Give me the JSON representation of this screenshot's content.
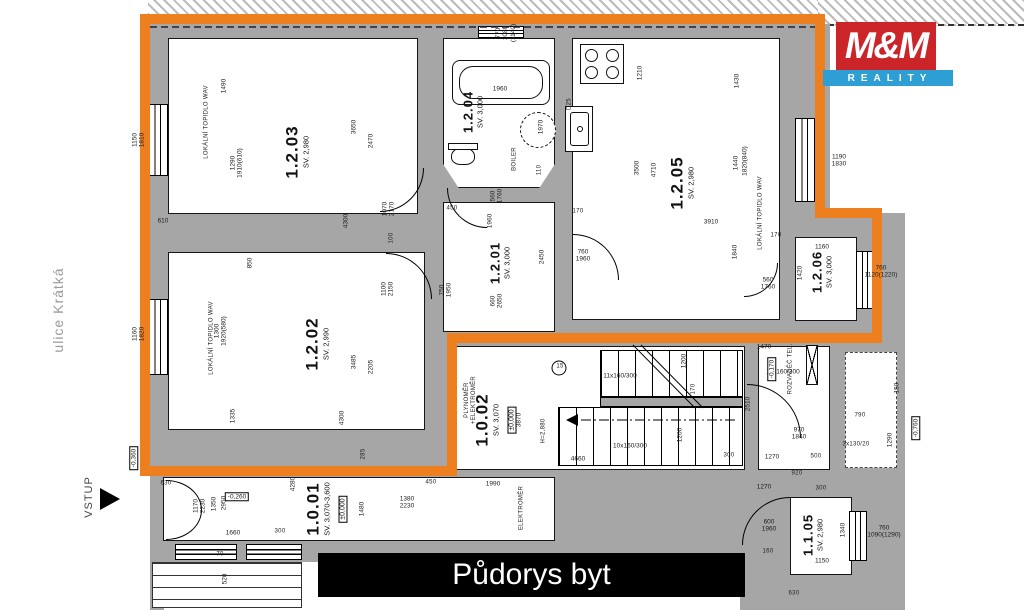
{
  "title_bar": {
    "text": "Půdorys byt"
  },
  "logo": {
    "line1": "M&M",
    "line2": "REALITY"
  },
  "street_label": "ulice Krátká",
  "entry_label": "VSTUP",
  "colors": {
    "boundary_orange": "#ee7f1e",
    "wall_gray": "#a6a6a6",
    "logo_red": "#cb2429",
    "logo_blue": "#2e9fd4",
    "title_bg": "#000000"
  },
  "rooms": [
    {
      "id": "1.2.03",
      "sv": "SV. 2,980",
      "x": 297,
      "y": 152
    },
    {
      "id": "1.2.02",
      "sv": "SV. 2,990",
      "x": 317,
      "y": 344
    },
    {
      "id": "1.2.04",
      "sv": "SV. 3,000",
      "x": 473,
      "y": 112,
      "small": true
    },
    {
      "id": "1.2.01",
      "sv": "SV. 3,000",
      "x": 500,
      "y": 263,
      "small": true
    },
    {
      "id": "1.2.05",
      "sv": "SV. 2,980",
      "x": 682,
      "y": 183
    },
    {
      "id": "1.2.06",
      "sv": "SV. 3,000",
      "x": 822,
      "y": 272,
      "small": true
    },
    {
      "id": "1.0.02",
      "sv": "SV. 3,070",
      "extra": "±0,000",
      "x": 496,
      "y": 420
    },
    {
      "id": "1.0.01",
      "sv": "SV. 3,070-3,600",
      "extra": "±0,000",
      "x": 327,
      "y": 509
    },
    {
      "id": "1.1.05",
      "sv": "SV. 2,980",
      "x": 813,
      "y": 535,
      "small": true
    }
  ],
  "annotations": [
    {
      "t": "1490",
      "x": 224,
      "y": 86
    },
    {
      "t": "1290\n1910(610)",
      "x": 237,
      "y": 163
    },
    {
      "t": "1150\n1810",
      "x": 139,
      "y": 140
    },
    {
      "t": "610",
      "x": 163,
      "y": 221,
      "r": 0
    },
    {
      "t": "1160\n1820",
      "x": 139,
      "y": 334
    },
    {
      "t": "3650",
      "x": 354,
      "y": 127
    },
    {
      "t": "2470",
      "x": 371,
      "y": 141
    },
    {
      "t": "1070\n2170",
      "x": 389,
      "y": 209
    },
    {
      "t": "4300",
      "x": 346,
      "y": 221
    },
    {
      "t": "100",
      "x": 392,
      "y": 238,
      "c": "sm"
    },
    {
      "t": "LOKÁLNÍ TOPIDLO WAV",
      "x": 207,
      "y": 122,
      "c": "sm"
    },
    {
      "t": "LOKÁLNÍ TOPIDLO WAV",
      "x": 212,
      "y": 338,
      "c": "sm"
    },
    {
      "t": "850",
      "x": 250,
      "y": 263
    },
    {
      "t": "1300\n1920(580)",
      "x": 221,
      "y": 331
    },
    {
      "t": "3485",
      "x": 354,
      "y": 362
    },
    {
      "t": "2205",
      "x": 371,
      "y": 367
    },
    {
      "t": "1335",
      "x": 233,
      "y": 416
    },
    {
      "t": "4300",
      "x": 342,
      "y": 418
    },
    {
      "t": "770\n1080\n(1140)",
      "x": 506,
      "y": 33
    },
    {
      "t": "1960",
      "x": 500,
      "y": 89,
      "r": 0
    },
    {
      "t": "1970",
      "x": 541,
      "y": 127
    },
    {
      "t": "BOILER",
      "x": 515,
      "y": 159,
      "c": "sm"
    },
    {
      "t": "110",
      "x": 540,
      "y": 170,
      "c": "sm"
    },
    {
      "t": "450",
      "x": 452,
      "y": 209,
      "r": 0,
      "c": "sm"
    },
    {
      "t": "560\n1760",
      "x": 497,
      "y": 196
    },
    {
      "t": "1960",
      "x": 490,
      "y": 221
    },
    {
      "t": "2450",
      "x": 542,
      "y": 257
    },
    {
      "t": "1100\n2150",
      "x": 388,
      "y": 289
    },
    {
      "t": "750\n1950",
      "x": 446,
      "y": 290
    },
    {
      "t": "660\n2650",
      "x": 497,
      "y": 301
    },
    {
      "t": "D25",
      "x": 570,
      "y": 104,
      "c": "sm"
    },
    {
      "t": "1210",
      "x": 640,
      "y": 73
    },
    {
      "t": "1430",
      "x": 737,
      "y": 81
    },
    {
      "t": "3500",
      "x": 637,
      "y": 168
    },
    {
      "t": "4710",
      "x": 654,
      "y": 170
    },
    {
      "t": "1440",
      "x": 736,
      "y": 163
    },
    {
      "t": "1820(840)",
      "x": 745,
      "y": 161
    },
    {
      "t": "LOKÁLNÍ TOPIDLO WAV",
      "x": 761,
      "y": 213,
      "c": "sm"
    },
    {
      "t": "170",
      "x": 578,
      "y": 212,
      "r": 0,
      "c": "sm"
    },
    {
      "t": "3910",
      "x": 711,
      "y": 222,
      "r": 0
    },
    {
      "t": "1840",
      "x": 735,
      "y": 252
    },
    {
      "t": "170",
      "x": 776,
      "y": 236,
      "r": 0,
      "c": "sm"
    },
    {
      "t": "760\n1960",
      "x": 583,
      "y": 256,
      "r": 0
    },
    {
      "t": "560\n1760",
      "x": 768,
      "y": 284,
      "r": 0
    },
    {
      "t": "1420",
      "x": 800,
      "y": 273
    },
    {
      "t": "1160",
      "x": 822,
      "y": 247,
      "r": 0
    },
    {
      "t": "760\n1120(1220)",
      "x": 881,
      "y": 272,
      "r": 0
    },
    {
      "t": "1190\n1830",
      "x": 839,
      "y": 161,
      "r": 0
    },
    {
      "t": "PLYNOMĚR\n+ELEKTROMĚR",
      "x": 471,
      "y": 400,
      "c": "sm"
    },
    {
      "t": "3870",
      "x": 519,
      "y": 420
    },
    {
      "t": "H=2,880",
      "x": 544,
      "y": 431,
      "c": "sm"
    },
    {
      "t": "15",
      "x": 560,
      "y": 367,
      "r": 0,
      "c": "sm"
    },
    {
      "t": "11x160/300",
      "x": 620,
      "y": 376,
      "r": 0
    },
    {
      "t": "11x160/300",
      "x": 783,
      "y": 372,
      "r": 0
    },
    {
      "t": "1200",
      "x": 684,
      "y": 361
    },
    {
      "t": "170",
      "x": 694,
      "y": 389,
      "c": "sm"
    },
    {
      "t": "2510",
      "x": 748,
      "y": 404
    },
    {
      "t": "1470",
      "x": 764,
      "y": 347,
      "r": 0
    },
    {
      "t": "1200",
      "x": 680,
      "y": 435
    },
    {
      "t": "10x160/300",
      "x": 630,
      "y": 446,
      "r": 0
    },
    {
      "t": "300",
      "x": 729,
      "y": 456,
      "r": 0,
      "c": "sm"
    },
    {
      "t": "1270",
      "x": 772,
      "y": 457,
      "r": 0
    },
    {
      "t": "970\n1840",
      "x": 799,
      "y": 434,
      "r": 0
    },
    {
      "t": "500",
      "x": 816,
      "y": 457,
      "r": 0,
      "c": "sm"
    },
    {
      "t": "ROZVADĚČ TEL.",
      "x": 791,
      "y": 369,
      "c": "sm"
    },
    {
      "t": "-0,170",
      "x": 772,
      "y": 369,
      "c": "lvl"
    },
    {
      "t": "4660",
      "x": 578,
      "y": 459,
      "r": 0
    },
    {
      "t": "150",
      "x": 897,
      "y": 388
    },
    {
      "t": "1290",
      "x": 890,
      "y": 440
    },
    {
      "t": "790",
      "x": 860,
      "y": 416,
      "r": 0,
      "c": "sm"
    },
    {
      "t": "3x130/20",
      "x": 856,
      "y": 445,
      "r": 0,
      "c": "sm"
    },
    {
      "t": "-0,760",
      "x": 916,
      "y": 428,
      "c": "lvl"
    },
    {
      "t": "630",
      "x": 166,
      "y": 484,
      "r": 0,
      "c": "sm"
    },
    {
      "t": "1170\n2230",
      "x": 200,
      "y": 506
    },
    {
      "t": "1350",
      "x": 214,
      "y": 504
    },
    {
      "t": "2950",
      "x": 224,
      "y": 503
    },
    {
      "t": "-0,260",
      "x": 237,
      "y": 497,
      "r": 0,
      "c": "lvl"
    },
    {
      "t": "1660",
      "x": 233,
      "y": 533,
      "r": 0
    },
    {
      "t": "300",
      "x": 280,
      "y": 532,
      "r": 0,
      "c": "sm"
    },
    {
      "t": "4280",
      "x": 293,
      "y": 484
    },
    {
      "t": "520",
      "x": 225,
      "y": 579
    },
    {
      "t": "70",
      "x": 220,
      "y": 555,
      "r": 0,
      "c": "sm"
    },
    {
      "t": "-0,360",
      "x": 134,
      "y": 458,
      "c": "lvl"
    },
    {
      "t": "1380\n2230",
      "x": 407,
      "y": 503,
      "r": 0
    },
    {
      "t": "450",
      "x": 431,
      "y": 483,
      "r": 0,
      "c": "sm"
    },
    {
      "t": "1990",
      "x": 493,
      "y": 484,
      "r": 0
    },
    {
      "t": "ELEKTROMĚR",
      "x": 522,
      "y": 508,
      "c": "sm"
    },
    {
      "t": "1480",
      "x": 362,
      "y": 509
    },
    {
      "t": "285",
      "x": 364,
      "y": 454,
      "c": "sm"
    },
    {
      "t": "920",
      "x": 797,
      "y": 474,
      "r": 0,
      "c": "sm"
    },
    {
      "t": "1270",
      "x": 764,
      "y": 487,
      "r": 0
    },
    {
      "t": "300",
      "x": 821,
      "y": 489,
      "r": 0,
      "c": "sm"
    },
    {
      "t": "600\n1960",
      "x": 769,
      "y": 526,
      "r": 0
    },
    {
      "t": "1340",
      "x": 843,
      "y": 530
    },
    {
      "t": "160",
      "x": 768,
      "y": 552,
      "r": 0,
      "c": "sm"
    },
    {
      "t": "1150",
      "x": 822,
      "y": 561,
      "r": 0
    },
    {
      "t": "760\n1090(1290)",
      "x": 884,
      "y": 532,
      "r": 0
    },
    {
      "t": "630",
      "x": 794,
      "y": 594,
      "r": 0,
      "c": "sm"
    }
  ]
}
